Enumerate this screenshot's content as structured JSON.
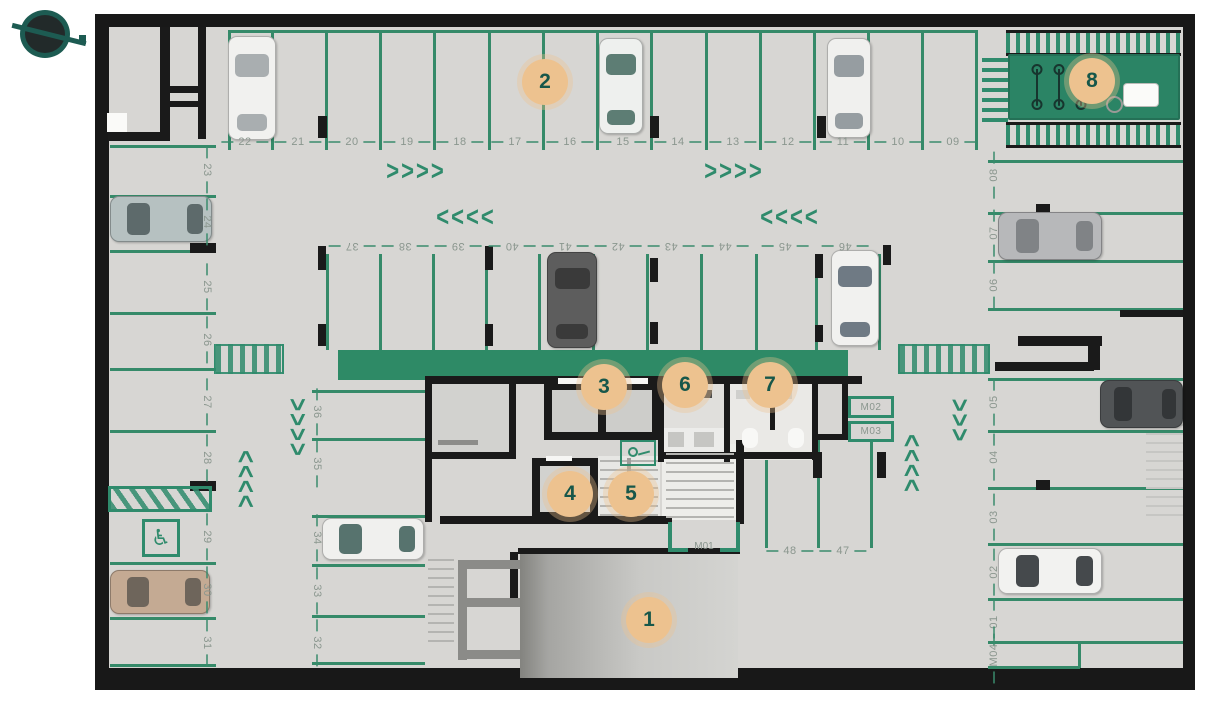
{
  "colors": {
    "floor": "#d7d6d3",
    "wall": "#1a1a1a",
    "parking_line": "#358a69",
    "green_band": "#2e8a66",
    "bike_zone": "#2b8465",
    "marker_bg": "#edc28f",
    "marker_text": "#17574a",
    "spot_number_text": "#8a968e",
    "logo_teal": "#1d5b52"
  },
  "legend_markers": [
    {
      "label": "1",
      "x": 649,
      "y": 620
    },
    {
      "label": "2",
      "x": 545,
      "y": 82
    },
    {
      "label": "3",
      "x": 604,
      "y": 387
    },
    {
      "label": "4",
      "x": 570,
      "y": 494
    },
    {
      "label": "5",
      "x": 631,
      "y": 494
    },
    {
      "label": "6",
      "x": 685,
      "y": 385
    },
    {
      "label": "7",
      "x": 770,
      "y": 385
    },
    {
      "label": "8",
      "x": 1092,
      "y": 81
    }
  ],
  "spot_groups": [
    {
      "group": "top-row",
      "rot": 0,
      "y": 142,
      "labels": [
        [
          "22",
          245
        ],
        [
          "21",
          298
        ],
        [
          "20",
          352
        ],
        [
          "19",
          407
        ],
        [
          "18",
          460
        ],
        [
          "17",
          515
        ],
        [
          "16",
          570
        ],
        [
          "15",
          623
        ],
        [
          "14",
          678
        ],
        [
          "13",
          733
        ],
        [
          "12",
          788
        ],
        [
          "11",
          843
        ],
        [
          "10",
          898
        ],
        [
          "09",
          953
        ]
      ]
    },
    {
      "group": "island-row",
      "rot": 180,
      "y": 246,
      "labels": [
        [
          "37",
          352
        ],
        [
          "38",
          405
        ],
        [
          "39",
          458
        ],
        [
          "40",
          512
        ],
        [
          "41",
          565
        ],
        [
          "42",
          618
        ],
        [
          "43",
          671
        ],
        [
          "44",
          725
        ],
        [
          "45",
          785
        ],
        [
          "46",
          845
        ]
      ]
    },
    {
      "group": "left-col",
      "rot": 90,
      "x": 207,
      "labels": [
        [
          "23",
          170
        ],
        [
          "24",
          222
        ],
        [
          "25",
          287
        ],
        [
          "26",
          340
        ],
        [
          "27",
          402
        ],
        [
          "28",
          458
        ],
        [
          "29",
          537
        ],
        [
          "30",
          590
        ],
        [
          "31",
          643
        ]
      ]
    },
    {
      "group": "mid-col",
      "rot": 90,
      "x": 317,
      "labels": [
        [
          "36",
          412
        ],
        [
          "35",
          464
        ],
        [
          "34",
          538
        ],
        [
          "33",
          591
        ],
        [
          "32",
          643
        ]
      ]
    },
    {
      "group": "right-col",
      "rot": -90,
      "x": 994,
      "labels": [
        [
          "08",
          175
        ],
        [
          "07",
          233
        ],
        [
          "06",
          285
        ],
        [
          "05",
          402
        ],
        [
          "04",
          457
        ],
        [
          "03",
          517
        ],
        [
          "02",
          572
        ],
        [
          "01",
          622
        ],
        [
          "M04",
          655
        ]
      ]
    },
    {
      "group": "core-row",
      "rot": 0,
      "y": 551,
      "labels": [
        [
          "48",
          790
        ],
        [
          "47",
          843
        ]
      ]
    }
  ],
  "moto_boxes": [
    {
      "label": "M02",
      "x": 848,
      "y": 396,
      "w": 46,
      "h": 22
    },
    {
      "label": "M03",
      "x": 848,
      "y": 421,
      "w": 46,
      "h": 21
    }
  ],
  "plan": {
    "green_lines": [
      [
        228,
        30,
        750,
        3
      ],
      [
        228,
        32,
        3,
        118
      ],
      [
        271,
        32,
        3,
        118
      ],
      [
        325,
        32,
        3,
        118
      ],
      [
        379,
        32,
        3,
        118
      ],
      [
        433,
        32,
        3,
        118
      ],
      [
        488,
        32,
        3,
        118
      ],
      [
        542,
        32,
        3,
        118
      ],
      [
        596,
        32,
        3,
        118
      ],
      [
        650,
        32,
        3,
        118
      ],
      [
        705,
        32,
        3,
        118
      ],
      [
        759,
        32,
        3,
        118
      ],
      [
        813,
        32,
        3,
        118
      ],
      [
        867,
        32,
        3,
        118
      ],
      [
        921,
        32,
        3,
        118
      ],
      [
        975,
        32,
        3,
        118
      ],
      [
        326,
        254,
        3,
        96
      ],
      [
        379,
        254,
        3,
        96
      ],
      [
        432,
        254,
        3,
        96
      ],
      [
        485,
        254,
        3,
        96
      ],
      [
        538,
        254,
        3,
        96
      ],
      [
        592,
        254,
        3,
        96
      ],
      [
        646,
        254,
        3,
        96
      ],
      [
        700,
        254,
        3,
        96
      ],
      [
        755,
        254,
        3,
        96
      ],
      [
        815,
        254,
        3,
        96
      ],
      [
        878,
        254,
        3,
        96
      ],
      [
        110,
        145,
        106,
        3
      ],
      [
        110,
        195,
        106,
        3
      ],
      [
        110,
        250,
        106,
        3
      ],
      [
        110,
        312,
        106,
        3
      ],
      [
        110,
        368,
        106,
        3
      ],
      [
        110,
        430,
        106,
        3
      ],
      [
        110,
        562,
        106,
        3
      ],
      [
        110,
        617,
        106,
        3
      ],
      [
        110,
        664,
        106,
        3
      ],
      [
        312,
        390,
        113,
        3
      ],
      [
        312,
        438,
        113,
        3
      ],
      [
        312,
        515,
        113,
        3
      ],
      [
        312,
        564,
        113,
        3
      ],
      [
        312,
        615,
        113,
        3
      ],
      [
        312,
        662,
        113,
        3
      ],
      [
        765,
        440,
        3,
        108
      ],
      [
        817,
        440,
        3,
        108
      ],
      [
        870,
        440,
        3,
        108
      ],
      [
        988,
        160,
        195,
        3
      ],
      [
        988,
        212,
        195,
        3
      ],
      [
        988,
        260,
        195,
        3
      ],
      [
        988,
        308,
        195,
        3
      ],
      [
        988,
        378,
        195,
        3
      ],
      [
        988,
        430,
        195,
        3
      ],
      [
        988,
        487,
        195,
        3
      ],
      [
        988,
        543,
        195,
        3
      ],
      [
        988,
        598,
        195,
        3
      ],
      [
        988,
        641,
        195,
        3
      ],
      [
        988,
        666,
        92,
        3
      ],
      [
        1078,
        641,
        3,
        27
      ]
    ],
    "fills": [
      [
        432,
        384,
        77,
        70,
        "#d2d2cf"
      ],
      [
        664,
        382,
        60,
        78,
        "#e0dfdc"
      ],
      [
        730,
        382,
        82,
        78,
        "#eae9e6"
      ],
      [
        662,
        444,
        76,
        76,
        "#ededea"
      ],
      [
        598,
        456,
        62,
        62,
        "#e7e7e4"
      ],
      [
        338,
        350,
        510,
        30,
        "#2e8a66"
      ]
    ],
    "walls": [
      [
        160,
        27,
        10,
        112
      ],
      [
        198,
        27,
        8,
        112
      ],
      [
        160,
        86,
        46,
        7
      ],
      [
        160,
        101,
        46,
        6
      ],
      [
        108,
        132,
        62,
        9
      ],
      [
        425,
        376,
        437,
        8
      ],
      [
        425,
        376,
        7,
        146
      ],
      [
        427,
        452,
        89,
        7
      ],
      [
        440,
        516,
        232,
        8
      ],
      [
        509,
        384,
        7,
        74
      ],
      [
        544,
        382,
        118,
        58
      ],
      [
        658,
        382,
        6,
        80
      ],
      [
        724,
        382,
        6,
        80
      ],
      [
        770,
        384,
        5,
        46
      ],
      [
        812,
        382,
        6,
        78
      ],
      [
        842,
        382,
        6,
        56
      ],
      [
        812,
        434,
        36,
        6
      ],
      [
        658,
        452,
        160,
        7
      ],
      [
        532,
        458,
        66,
        62
      ],
      [
        736,
        440,
        8,
        84
      ],
      [
        1018,
        336,
        84,
        10
      ],
      [
        995,
        362,
        99,
        9
      ],
      [
        1088,
        336,
        12,
        34
      ],
      [
        1120,
        310,
        63,
        7
      ],
      [
        518,
        548,
        222,
        6
      ],
      [
        510,
        552,
        8,
        52
      ],
      [
        318,
        116,
        9,
        22
      ],
      [
        650,
        116,
        9,
        22
      ],
      [
        817,
        116,
        9,
        22
      ],
      [
        318,
        246,
        8,
        24
      ],
      [
        318,
        324,
        8,
        22
      ],
      [
        485,
        246,
        8,
        24
      ],
      [
        485,
        324,
        8,
        22
      ],
      [
        650,
        258,
        8,
        24
      ],
      [
        650,
        322,
        8,
        22
      ],
      [
        815,
        254,
        8,
        24
      ],
      [
        815,
        325,
        8,
        17
      ],
      [
        883,
        245,
        8,
        20
      ],
      [
        190,
        243,
        26,
        10
      ],
      [
        190,
        481,
        26,
        10
      ],
      [
        1036,
        204,
        14,
        10
      ],
      [
        1036,
        480,
        14,
        10
      ],
      [
        813,
        452,
        9,
        26
      ],
      [
        877,
        452,
        9,
        26
      ]
    ],
    "fills2": [
      [
        552,
        390,
        46,
        42,
        "#cdcdca"
      ],
      [
        606,
        390,
        46,
        42,
        "#cdcdca"
      ],
      [
        558,
        378,
        34,
        6,
        "#f6f6f4"
      ],
      [
        614,
        378,
        34,
        6,
        "#f6f6f4"
      ],
      [
        540,
        466,
        50,
        46,
        "#d2d2cf"
      ],
      [
        546,
        456,
        26,
        5,
        "#f6f6f4"
      ],
      [
        438,
        440,
        40,
        5,
        "#8d8d8a"
      ],
      [
        668,
        390,
        12,
        8,
        "#4c4c4c"
      ],
      [
        684,
        390,
        12,
        8,
        "#4c4c4c"
      ],
      [
        700,
        390,
        12,
        8,
        "#4c4c4c"
      ],
      [
        664,
        428,
        60,
        24,
        "#ececea"
      ],
      [
        668,
        432,
        16,
        15,
        "#c6c6c3"
      ],
      [
        694,
        432,
        20,
        15,
        "#c6c6c3"
      ],
      [
        736,
        390,
        14,
        9,
        "#cfcfcc"
      ],
      [
        778,
        390,
        14,
        9,
        "#cfcfcc"
      ],
      [
        742,
        428,
        16,
        20,
        "#f8f8f6",
        7
      ],
      [
        788,
        428,
        16,
        20,
        "#f8f8f6",
        7
      ],
      [
        107,
        113,
        20,
        19,
        "#fafaf8"
      ]
    ],
    "misc": [
      {
        "cls": "ramp",
        "name": "vehicle-ramp",
        "x": 520,
        "y": 554,
        "w": 218,
        "h": 124
      },
      {
        "cls": "rampL",
        "name": "ramp-edge",
        "x": 520,
        "y": 554,
        "w": 28,
        "h": 124
      },
      {
        "cls": "treads",
        "name": "stairs",
        "x": 428,
        "y": 554,
        "w": 26,
        "h": 88
      },
      {
        "cls": "treads",
        "name": "stairs",
        "x": 600,
        "y": 458,
        "w": 58,
        "h": 58
      },
      {
        "cls": "treads",
        "name": "stairs",
        "x": 666,
        "y": 448,
        "w": 68,
        "h": 70
      },
      {
        "cls": "treads-l",
        "name": "stairs",
        "x": 1146,
        "y": 422,
        "w": 37,
        "h": 94
      },
      {
        "cls": "rail",
        "name": "stair-rail",
        "x": 627,
        "y": 458,
        "w": 4,
        "h": 58
      },
      {
        "cls": "grayw",
        "name": "wall-segment-gray",
        "x": 458,
        "y": 560,
        "w": 9,
        "h": 100
      },
      {
        "cls": "grayw",
        "name": "wall-segment-gray",
        "x": 458,
        "y": 560,
        "w": 62,
        "h": 9
      },
      {
        "cls": "grayw",
        "name": "wall-segment-gray",
        "x": 458,
        "y": 598,
        "w": 62,
        "h": 9
      },
      {
        "cls": "grayw",
        "name": "wall-segment-gray",
        "x": 458,
        "y": 650,
        "w": 62,
        "h": 9
      },
      {
        "cls": "cross",
        "name": "pedestrian-crossing",
        "x": 214,
        "y": 344,
        "w": 70,
        "h": 30
      },
      {
        "cls": "cross",
        "name": "pedestrian-crossing",
        "x": 898,
        "y": 344,
        "w": 92,
        "h": 30
      },
      {
        "cls": "hatchv",
        "name": "bike-rack-stripes",
        "x": 1006,
        "y": 30,
        "w": 175,
        "h": 26
      },
      {
        "cls": "hatchv",
        "name": "bike-rack-stripes",
        "x": 1006,
        "y": 122,
        "w": 175,
        "h": 26
      },
      {
        "cls": "hatchh",
        "name": "bike-rack-stripes",
        "x": 982,
        "y": 56,
        "w": 26,
        "h": 66
      },
      {
        "cls": "bikezone",
        "name": "bike-parking-zone",
        "x": 1008,
        "y": 54,
        "w": 172,
        "h": 66
      },
      {
        "cls": "bike",
        "name": "bicycle-icon",
        "x": 1030,
        "y": 64,
        "w": 14,
        "h": 46
      },
      {
        "cls": "bike",
        "name": "bicycle-icon",
        "x": 1052,
        "y": 64,
        "w": 14,
        "h": 46
      },
      {
        "cls": "bike",
        "name": "bicycle-icon",
        "x": 1074,
        "y": 64,
        "w": 14,
        "h": 46
      },
      {
        "cls": "wbox",
        "name": "storage-box",
        "x": 1124,
        "y": 84,
        "w": 34,
        "h": 22
      },
      {
        "cls": "ringg",
        "name": "circle-detail",
        "x": 1106,
        "y": 96,
        "w": 17,
        "h": 17
      },
      {
        "cls": "hatchd",
        "name": "no-parking-hatch",
        "x": 108,
        "y": 486,
        "w": 104,
        "h": 26
      },
      {
        "cls": "accbox",
        "name": "accessible-parking-icon",
        "x": 142,
        "y": 519,
        "w": 38,
        "h": 38,
        "text": "♿"
      },
      {
        "cls": "amen",
        "name": "amenity-icon",
        "x": 620,
        "y": 440,
        "w": 36,
        "h": 26
      },
      {
        "cls": "gl",
        "name": "moto-spot-line",
        "x": 668,
        "y": 522,
        "w": 4,
        "h": 28
      },
      {
        "cls": "gl",
        "name": "moto-spot-line",
        "x": 736,
        "y": 522,
        "w": 4,
        "h": 28
      },
      {
        "cls": "gl",
        "name": "moto-spot-line",
        "x": 668,
        "y": 548,
        "w": 20,
        "h": 4
      },
      {
        "cls": "gl",
        "name": "moto-spot-line",
        "x": 720,
        "y": 548,
        "w": 20,
        "h": 4
      },
      {
        "cls": "mlab",
        "name": "moto-spot-label",
        "x": 684,
        "y": 540,
        "w": 40,
        "h": 12,
        "text": "M01"
      }
    ],
    "cars": [
      [
        228,
        36,
        48,
        104,
        "v",
        "#f1f1ef",
        "#a9aeb0"
      ],
      [
        599,
        38,
        44,
        96,
        "v",
        "#eef0ee",
        "#5d7d74"
      ],
      [
        827,
        38,
        44,
        100,
        "v",
        "#f0f0ee",
        "#969da1"
      ],
      [
        110,
        196,
        102,
        46,
        "h",
        "#b6c1c1",
        "#5d6a6b"
      ],
      [
        110,
        570,
        100,
        44,
        "h",
        "#c4aa93",
        "#6e655b"
      ],
      [
        547,
        252,
        50,
        96,
        "v",
        "#5d5d5d",
        "#3a3a3a"
      ],
      [
        831,
        250,
        48,
        96,
        "v",
        "#f1f1ef",
        "#6f7a84"
      ],
      [
        322,
        518,
        102,
        42,
        "h",
        "#f0f0ee",
        "#57736e"
      ],
      [
        998,
        212,
        104,
        48,
        "h",
        "#b7b8ba",
        "#808386"
      ],
      [
        1100,
        380,
        83,
        48,
        "h",
        "#515456",
        "#333638"
      ],
      [
        998,
        548,
        104,
        46,
        "h",
        "#f2f2f0",
        "#45494c"
      ]
    ],
    "arrows": [
      {
        "x": 416,
        "y": 171,
        "rot": 0,
        "t": ">>>>"
      },
      {
        "x": 734,
        "y": 171,
        "rot": 0,
        "t": ">>>>"
      },
      {
        "x": 466,
        "y": 217,
        "rot": 0,
        "t": "<<<<"
      },
      {
        "x": 790,
        "y": 217,
        "rot": 0,
        "t": "<<<<"
      },
      {
        "x": 246,
        "y": 478,
        "rot": -90,
        "t": ">>>>"
      },
      {
        "x": 297,
        "y": 428,
        "rot": 90,
        "t": ">>>>"
      },
      {
        "x": 959,
        "y": 421,
        "rot": 90,
        "t": ">>>"
      },
      {
        "x": 912,
        "y": 462,
        "rot": -90,
        "t": ">>>>"
      }
    ]
  }
}
